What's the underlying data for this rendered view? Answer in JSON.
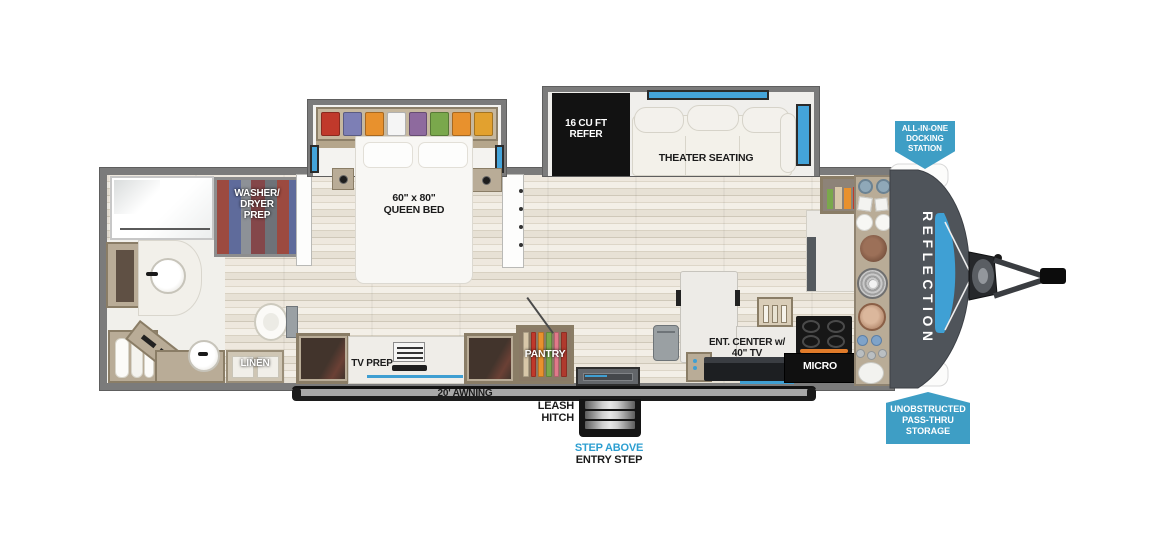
{
  "branding": {
    "model": "REFLECTION"
  },
  "callouts": {
    "docking_station": "ALL-IN-ONE\nDOCKING\nSTATION",
    "pass_thru": "UNOBSTRUCTED\nPASS-THRU\nSTORAGE"
  },
  "labels": {
    "refer": "16 CU FT\nREFER",
    "theater_seating": "THEATER SEATING",
    "queen_bed": "60\" x 80\"\nQUEEN BED",
    "washer_dryer_prep": "WASHER/\nDRYER\nPREP",
    "linen": "LINEN",
    "tv_prep": "TV PREP",
    "pantry": "PANTRY",
    "ent_center": "ENT. CENTER w/\n40\" TV",
    "micro": "MICRO",
    "awning": "20' AWNING",
    "leash_hitch": "LEASH\nHITCH",
    "step_above": "STEP ABOVE",
    "entry_step": "ENTRY STEP"
  },
  "colors": {
    "badge_blue": "#3E9EC5",
    "window_blue": "#44A4DA",
    "step_above_blue": "#2D9FD1",
    "nose_gray": "#4F545A",
    "wall_gray": "#7B7B7B",
    "floor_light": "#EDE8DE",
    "cabinet_tan": "#B9AC97",
    "appliance_black": "#141414"
  },
  "palette": {
    "wardrobe_clothes": [
      "#C0392B",
      "#7D7FB5",
      "#E8912D",
      "#F5F5F5",
      "#8E6A9E",
      "#7AA84C",
      "#E8912D",
      "#E2A12F"
    ],
    "pantry_items": [
      "#D8C7A9",
      "#C0392B",
      "#E8912D",
      "#7AA84C",
      "#E07A8A",
      "#B03A2E"
    ]
  }
}
